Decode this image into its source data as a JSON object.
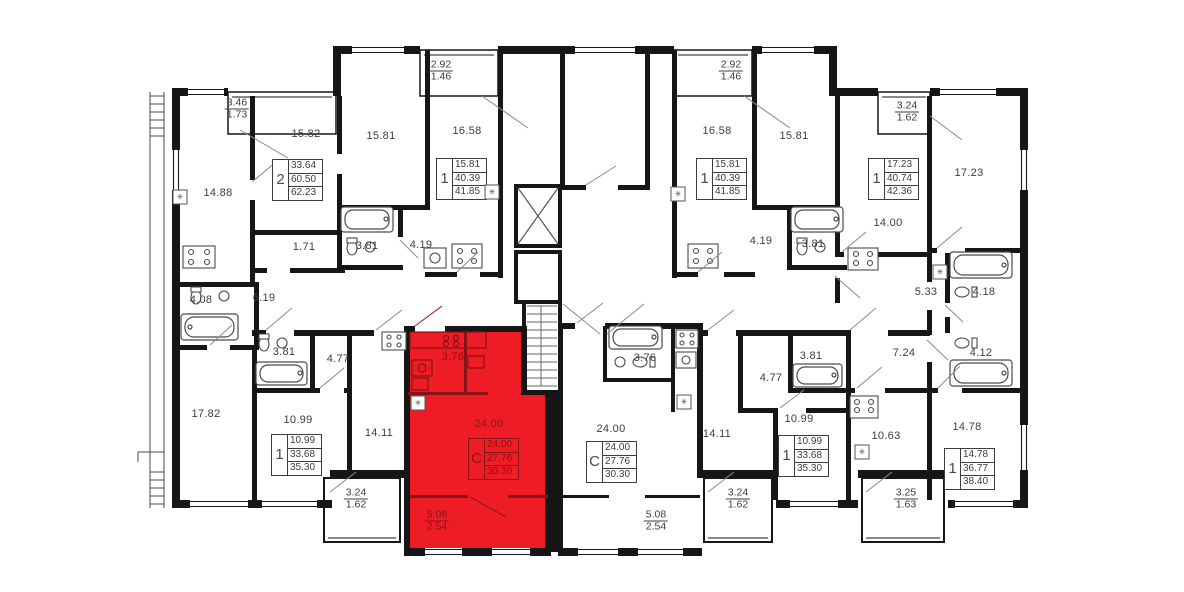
{
  "palette": {
    "apartment_red": "#ee1c25",
    "dark_red": "#8a1216",
    "wall": "#161616",
    "label": "#3d3d3d"
  },
  "icons": {
    "vent": "✳"
  },
  "room_labels": [
    "14.88",
    "15.82",
    "15.81",
    "16.58",
    "16.58",
    "15.81",
    "14.00",
    "17.23",
    "4.08",
    "6.19",
    "1.71",
    "3.81",
    "4.19",
    "4.19",
    "3.81",
    "5.33",
    "4.18",
    "17.82",
    "3.81",
    "4.77",
    "10.99",
    "14.11",
    "3.76",
    "24.00",
    "3.76",
    "24.00",
    "14.11",
    "4.77",
    "3.81",
    "7.24",
    "4.12",
    "10.63",
    "14.78",
    "10.99"
  ],
  "balcony_labels": [
    {
      "top": "3.46",
      "bottom": "1.73"
    },
    {
      "top": "2.92",
      "bottom": "1.46"
    },
    {
      "top": "2.92",
      "bottom": "1.46"
    },
    {
      "top": "3.24",
      "bottom": "1.62"
    },
    {
      "top": "3.24",
      "bottom": "1.62"
    },
    {
      "top": "3.24",
      "bottom": "1.62"
    },
    {
      "top": "3.25",
      "bottom": "1.63"
    },
    {
      "top": "5.08",
      "bottom": "2.54"
    },
    {
      "top": "5.08",
      "bottom": "2.54"
    }
  ],
  "apartments": [
    {
      "type": "2",
      "values": [
        "33.64",
        "60.50",
        "62.23"
      ]
    },
    {
      "type": "1",
      "values": [
        "15.81",
        "40.39",
        "41.85"
      ]
    },
    {
      "type": "1",
      "values": [
        "15.81",
        "40.39",
        "41.85"
      ]
    },
    {
      "type": "1",
      "values": [
        "17.23",
        "40.74",
        "42.36"
      ]
    },
    {
      "type": "1",
      "values": [
        "10.99",
        "33.68",
        "35.30"
      ]
    },
    {
      "type": "C",
      "values": [
        "24.00",
        "27.76",
        "30.30"
      ]
    },
    {
      "type": "C",
      "values": [
        "24.00",
        "27.76",
        "30.30"
      ]
    },
    {
      "type": "1",
      "values": [
        "10.99",
        "33.68",
        "35.30"
      ]
    },
    {
      "type": "1",
      "values": [
        "14.78",
        "36.77",
        "38.40"
      ]
    }
  ]
}
